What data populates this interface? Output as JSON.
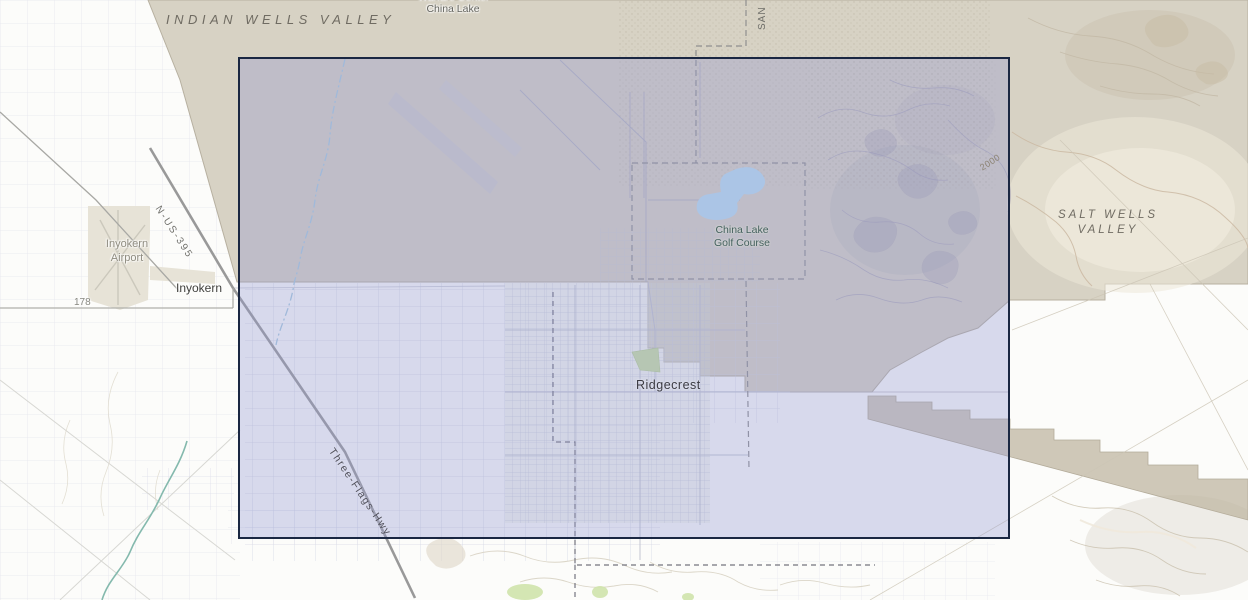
{
  "map": {
    "region_labels": {
      "indian_wells_valley": "INDIAN WELLS VALLEY",
      "salt_wells_line1": "SALT WELLS",
      "salt_wells_line2": "VALLEY"
    },
    "place_labels": {
      "warfare_center_partial": "Warfare Center",
      "china_lake": "China Lake",
      "county_label_partial": "SAN",
      "inyokern_airport_line1": "Inyokern",
      "inyokern_airport_line2": "Airport",
      "inyokern_town": "Inyokern",
      "ridgecrest": "Ridgecrest",
      "golf_course_line1": "China Lake",
      "golf_course_line2": "Golf Course"
    },
    "road_labels": {
      "us_395": "N-US-395",
      "route_178": "178",
      "three_flags_hwy": "Three-Flags-Hwy"
    },
    "contour_labels": {
      "elev_2000": "2000"
    },
    "colors": {
      "selection_border": "#1a2742",
      "selection_fill": "rgba(147,152,210,0.35)",
      "military_land_tan": "#d7d2c4",
      "valley_floor_cream": "#ece7d9",
      "water_blue": "#b9ddf1",
      "stream_teal": "#84b9ad",
      "park_green": "#c9dfa3",
      "background": "#fcfcfa"
    }
  }
}
